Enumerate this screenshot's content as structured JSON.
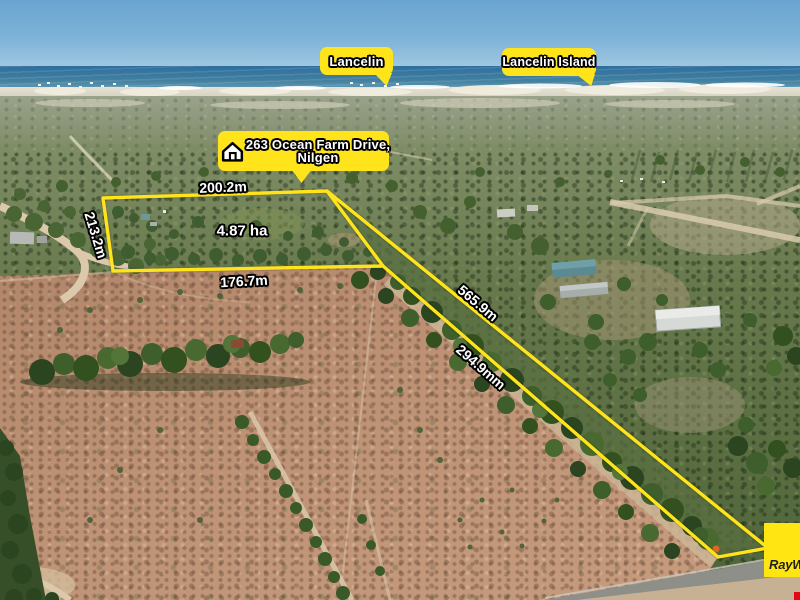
{
  "scene": {
    "type": "aerial-property-photo",
    "colors": {
      "annotation_yellow": "#FFE41C",
      "label_text": "#FFFFFF",
      "label_outline": "#000000",
      "brand_yellow": "#FFE512",
      "brand_text": "#1F1F1F",
      "brand_red": "#E30613"
    }
  },
  "place_labels": {
    "lancelin": "Lancelin",
    "lancelin_island": "Lancelin Island"
  },
  "address": {
    "line1": "263 Ocean Farm Drive,",
    "line2": "Nilgen"
  },
  "measurements": {
    "north": "200.2m",
    "west": "213.2m",
    "south": "176.7m",
    "area": "4.87 ha",
    "northeast": "565.9m",
    "southwest": "294.9mm"
  },
  "branding": {
    "agency_wordmark": "RayWhite."
  }
}
